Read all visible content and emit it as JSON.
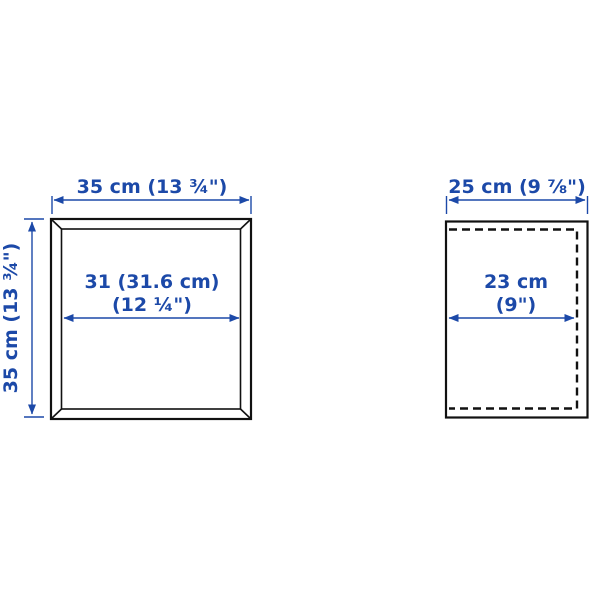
{
  "colors": {
    "dimension_blue": "#1c49a8",
    "line_black": "#111111",
    "background": "#ffffff"
  },
  "front_view": {
    "width_label": "35 cm (13 ¾\")",
    "height_label": "35 cm (13 ¾\")",
    "inner_width_line1": "31 (31.6 cm)",
    "inner_width_line2": "(12 ¼\")"
  },
  "side_view": {
    "depth_label": "25 cm (9 ⅞\")",
    "inner_depth_line1": "23 cm",
    "inner_depth_line2": "(9\")"
  }
}
